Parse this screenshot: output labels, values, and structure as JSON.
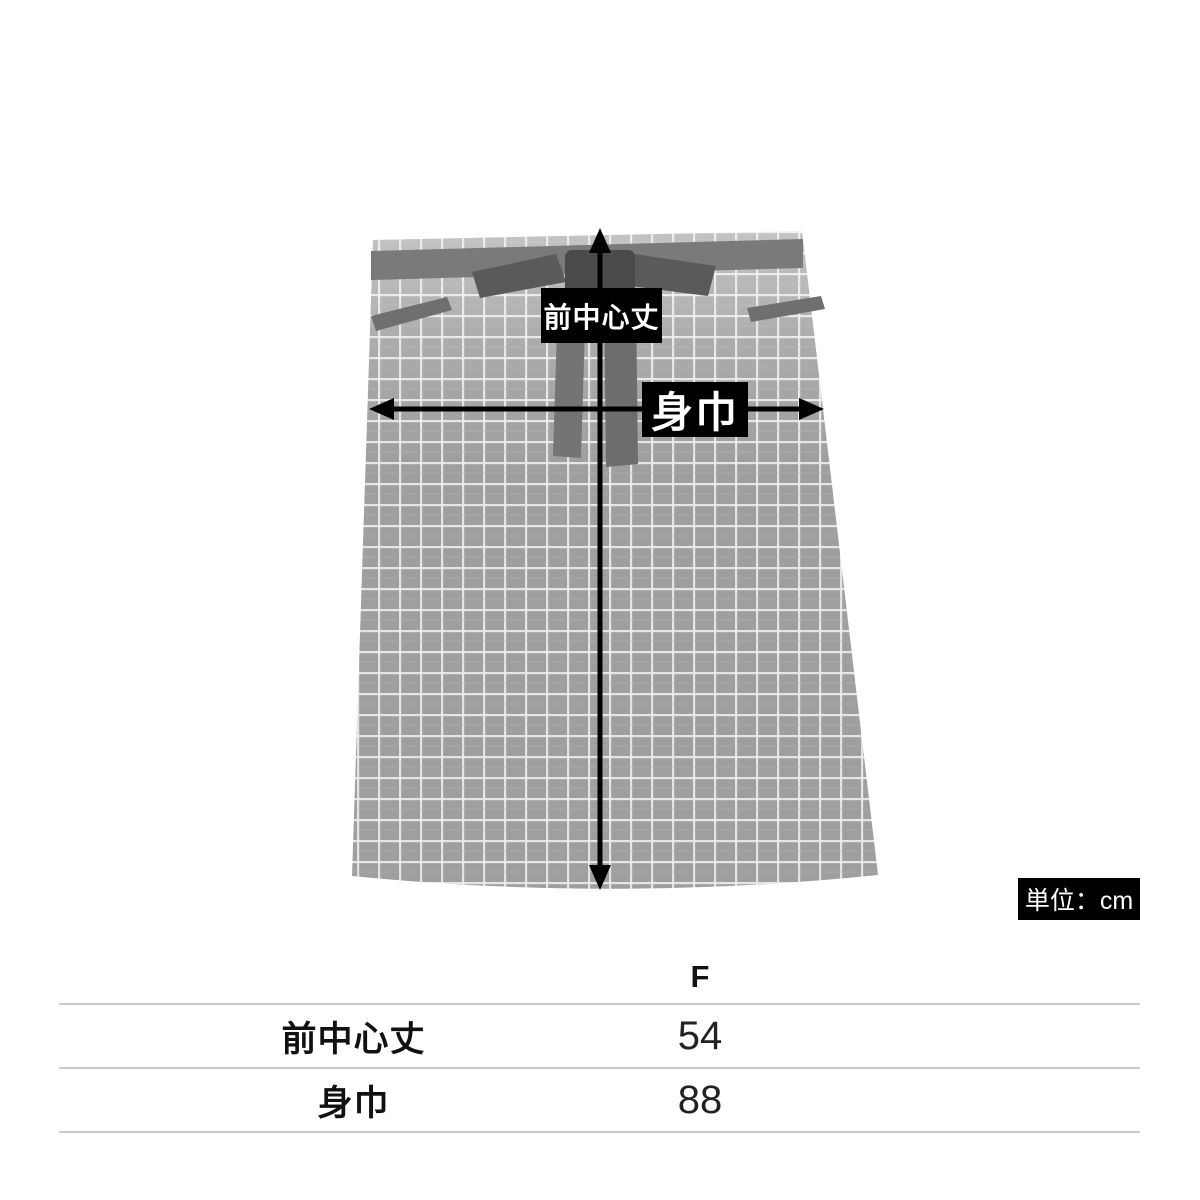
{
  "diagram": {
    "front_center_length_label": "前中心丈",
    "body_width_label": "身巾",
    "unit_label": "単位：cm"
  },
  "size_table": {
    "columns": [
      "F"
    ],
    "rows": [
      {
        "label": "前中心丈",
        "values": [
          "54"
        ]
      },
      {
        "label": "身巾",
        "values": [
          "88"
        ]
      }
    ]
  },
  "colors": {
    "background": "#ffffff",
    "label_bg": "#000000",
    "label_text": "#ffffff",
    "arrow": "#000000",
    "table_line": "#c9c9c9",
    "fabric": "#9f9f9f",
    "fabric_grid": "#ececec",
    "waistband": "#7a7a7a",
    "tie": "#5a5a5a"
  }
}
